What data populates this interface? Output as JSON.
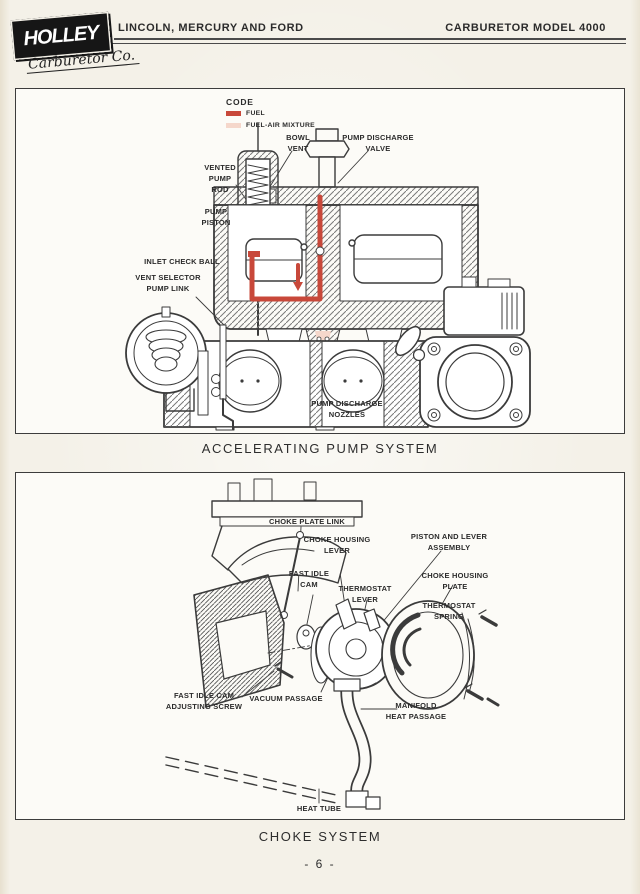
{
  "header": {
    "logo": {
      "name": "HOLLEY",
      "subtitle": "Carburetor Co."
    },
    "left_title": "LINCOLN, MERCURY AND FORD",
    "right_title": "CARBURETOR MODEL 4000"
  },
  "figure1": {
    "caption": "ACCELERATING PUMP SYSTEM",
    "legend": {
      "title": "CODE",
      "items": [
        {
          "label": "FUEL",
          "color": "#c8483a"
        },
        {
          "label": "FUEL-AIR MIXTURE",
          "color": "#f5d7cb"
        }
      ]
    },
    "labels": {
      "bowl_vent": "BOWL\nVENT",
      "pump_discharge_valve": "PUMP DISCHARGE\nVALVE",
      "vented_pump_rod": "VENTED\nPUMP\nROD",
      "pump_piston": "PUMP\nPISTON",
      "inlet_check_ball": "INLET CHECK BALL",
      "vent_selector_pump_link": "VENT SELECTOR\nPUMP LINK",
      "pump_discharge_nozzles": "PUMP DISCHARGE\nNOZZLES"
    }
  },
  "figure2": {
    "caption": "CHOKE SYSTEM",
    "labels": {
      "choke_plate_link": "CHOKE PLATE LINK",
      "choke_housing_lever": "CHOKE HOUSING\nLEVER",
      "piston_and_lever_assembly": "PISTON AND LEVER\nASSEMBLY",
      "fast_idle_cam": "FAST IDLE\nCAM",
      "thermostat_lever": "THERMOSTAT\nLEVER",
      "choke_housing_plate": "CHOKE HOUSING\nPLATE",
      "thermostat_spring": "THERMOSTAT\nSPRING",
      "fast_idle_cam_adjusting_screw": "FAST IDLE CAM\nADJUSTING SCREW",
      "vacuum_passage": "VACUUM PASSAGE",
      "manifold_heat_passage": "MANIFOLD\nHEAT PASSAGE",
      "heat_tube": "HEAT TUBE"
    }
  },
  "page": {
    "number_label": "- 6 -"
  },
  "colors": {
    "ink": "#3b3b3b",
    "fuel_red": "#c8483a",
    "fuel_air_pink": "#f5d7cb"
  }
}
